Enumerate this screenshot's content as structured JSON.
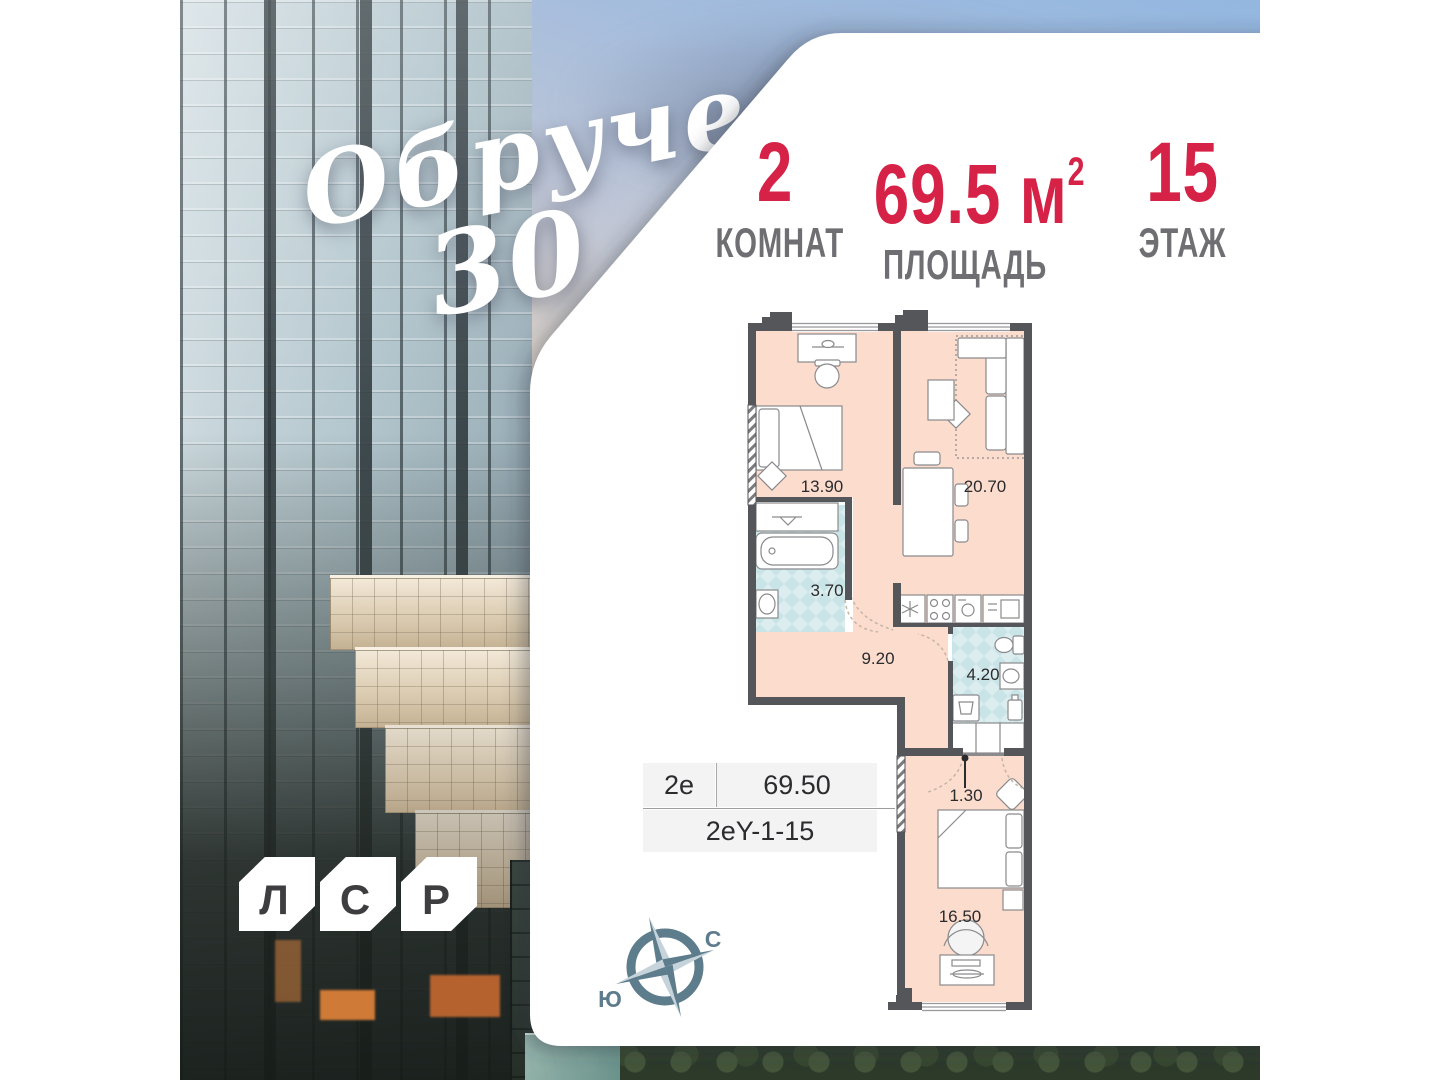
{
  "brand": {
    "project_line1": "Обручева",
    "project_line2": "30",
    "developer_letters": [
      "Л",
      "С",
      "Р"
    ]
  },
  "stats": {
    "rooms": {
      "value": "2",
      "label": "КОМНАТ"
    },
    "area": {
      "value": "69.5",
      "unit": "м",
      "sup": "2",
      "label": "ПЛОЩАДЬ"
    },
    "floor": {
      "value": "15",
      "label": "ЭТАЖ"
    }
  },
  "plan": {
    "rooms": [
      {
        "name": "bedroom",
        "area": "13.90"
      },
      {
        "name": "living-kitchen",
        "area": "20.70"
      },
      {
        "name": "bathroom",
        "area": "3.70"
      },
      {
        "name": "hallway",
        "area": "9.20"
      },
      {
        "name": "wc",
        "area": "4.20"
      },
      {
        "name": "entry",
        "area": "1.30"
      },
      {
        "name": "bedroom-2",
        "area": "16.50"
      }
    ],
    "info": {
      "type": "2е",
      "area": "69.50",
      "code": "2еY-1-15"
    },
    "compass": {
      "north": "С",
      "south": "Ю"
    }
  },
  "colors": {
    "accent": "#d62246",
    "wall": "#55565a",
    "room_fill": "#fbdccd",
    "wet_fill": "#d9edee",
    "slate": "#5d7c8c",
    "label_gray": "#6f6f73"
  }
}
